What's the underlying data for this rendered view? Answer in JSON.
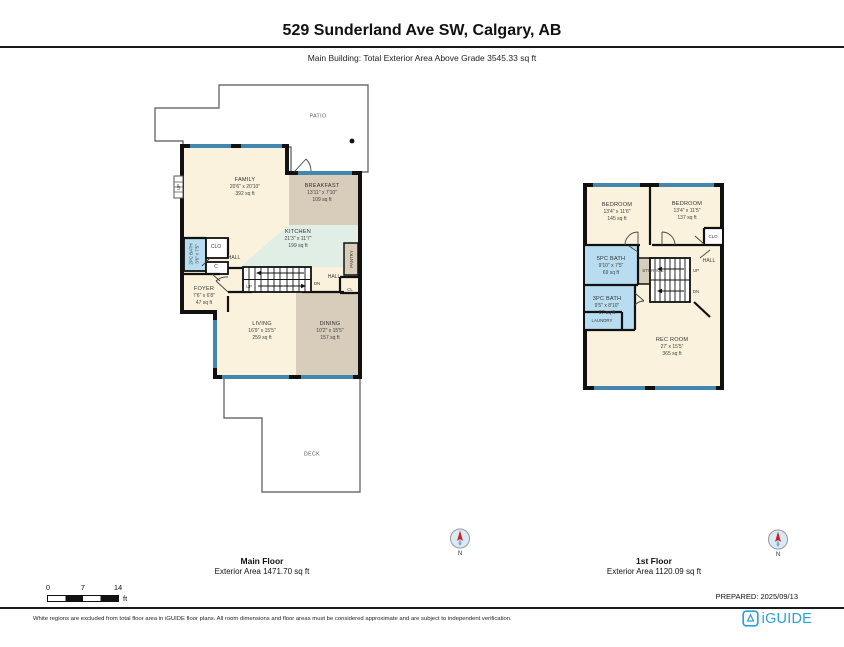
{
  "header": {
    "title": "529 Sunderland Ave SW, Calgary, AB",
    "subtitle": "Main Building: Total Exterior Area Above Grade 3545.33 sq ft"
  },
  "main_floor": {
    "caption_title": "Main Floor",
    "caption_area": "Exterior Area 1471.70 sq ft",
    "patio": "PATIO",
    "deck": "DECK",
    "rooms": {
      "family": {
        "name": "FAMILY",
        "dims": "20'6\" x 20'10\"",
        "area": "392 sq ft"
      },
      "breakfast": {
        "name": "BREAKFAST",
        "dims": "13'11\" x 7'10\"",
        "area": "109 sq ft"
      },
      "kitchen": {
        "name": "KITCHEN",
        "dims": "21'3\" x 11'7\"",
        "area": "199 sq ft"
      },
      "bath_2pc": {
        "name": "2PC BATH",
        "dims": "3'6\" x 7'5\""
      },
      "foyer": {
        "name": "FOYER",
        "dims": "7'6\" x 6'8\"",
        "area": "47 sq ft"
      },
      "living": {
        "name": "LIVING",
        "dims": "16'9\" x 15'5\"",
        "area": "259 sq ft"
      },
      "dining": {
        "name": "DINING",
        "dims": "10'2\" x 15'5\"",
        "area": "157 sq ft"
      }
    },
    "small_labels": {
      "hall": "HALL",
      "clo": "CLO",
      "closet_c": "C",
      "up": "UP",
      "dn": "DN",
      "hall2": "HALL",
      "cl": "CL",
      "pantry": "PANTRY",
      "up_entry": "UP"
    }
  },
  "first_floor": {
    "caption_title": "1st Floor",
    "caption_area": "Exterior Area 1120.09 sq ft",
    "rooms": {
      "bedroom_left": {
        "name": "BEDROOM",
        "dims": "13'4\" x 11'6\"",
        "area": "145 sq ft"
      },
      "bedroom_right": {
        "name": "BEDROOM",
        "dims": "13'4\" x 11'5\"",
        "area": "137 sq ft"
      },
      "bath_5pc": {
        "name": "5PC BATH",
        "dims": "9'10\" x 7'5\"",
        "area": "69 sq ft"
      },
      "bath_3pc": {
        "name": "3PC BATH",
        "dims": "9'5\" x 8'10\"",
        "area": "67 sq ft"
      },
      "rec_room": {
        "name": "REC ROOM",
        "dims": "27' x 15'5\"",
        "area": "365 sq ft"
      }
    },
    "small_labels": {
      "clo": "CLO",
      "storage": "STORAGE",
      "hall": "HALL",
      "up": "UP",
      "dn": "DN",
      "laundry": "LAUNDRY"
    }
  },
  "compass": {
    "label": "N"
  },
  "scale_bar": {
    "ticks": [
      "0",
      "7",
      "14"
    ],
    "unit": "ft"
  },
  "prepared": "PREPARED: 2025/09/13",
  "footer": {
    "disclaimer": "White regions are excluded from total floor area in iGUIDE floor plans. All room dimensions and floor areas must be considered approximate and are subject to independent verification.",
    "brand": "iGUIDE"
  },
  "icons": [
    "compass-icon",
    "iguide-logo-icon"
  ],
  "colors": {
    "wall": "#111111",
    "window": "#4487AE",
    "room_cream": "#FAF2DC",
    "room_tan": "#D8CCBB",
    "room_mint": "#E0EEE6",
    "room_blue": "#B9DDF0",
    "brand_blue": "#2AA0D8"
  }
}
